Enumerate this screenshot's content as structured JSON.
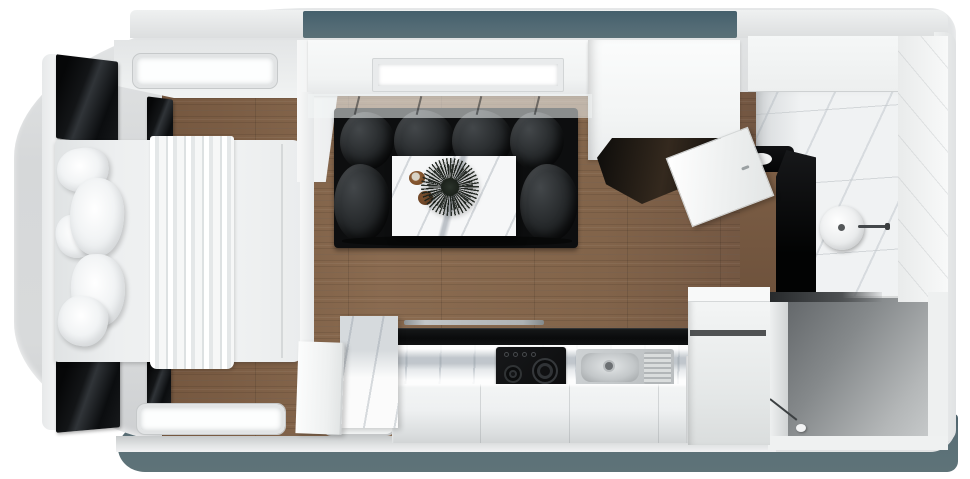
{
  "scene": {
    "type": "3d-render-top-view",
    "subject": "Caravan interior floor plan, bird's-eye cutaway render",
    "visible_text": []
  },
  "palette": {
    "shell": "#d8dadb",
    "underbody": "#5b7077",
    "roof-window": "#536b75",
    "wood": "#7e6047",
    "gloss-black": "#0b0d0f",
    "marble": "#f0f2f3",
    "steel": "#b8bcbe",
    "storage-gray": "#85898b"
  },
  "titles": {
    "shell": "Caravan body shell",
    "roof_window": "Tinted roof window band",
    "bed": "Double bed with draped sheet",
    "pillow": "Pillow",
    "cabinet": "Gloss black overhead cabinet",
    "window": "Wall window",
    "skylight": "Lounge skylight",
    "sofa": "Black U-shaped lounge sofa",
    "table": "Marble coffee table",
    "plant": "Decorative plant",
    "cup": "Cup",
    "bowl": "Bowl",
    "wardrobe": "Wardrobe unit",
    "wardrobe_door": "Open wardrobe door",
    "worktop": "Gloss black worktop",
    "cooktop": "Two-burner gas hob",
    "sink": "Stainless sink with drainer",
    "counter": "Marble kitchen counter",
    "entry": "Entry door",
    "partition": "Partition door panel",
    "bath_floor": "Marble bathroom floor",
    "basin": "Round bathroom basin",
    "shower": "Black shower column",
    "vanity": "Black vanity shelf",
    "storage": "Rear storage compartment floor",
    "underbody": "Underbody shadow"
  }
}
